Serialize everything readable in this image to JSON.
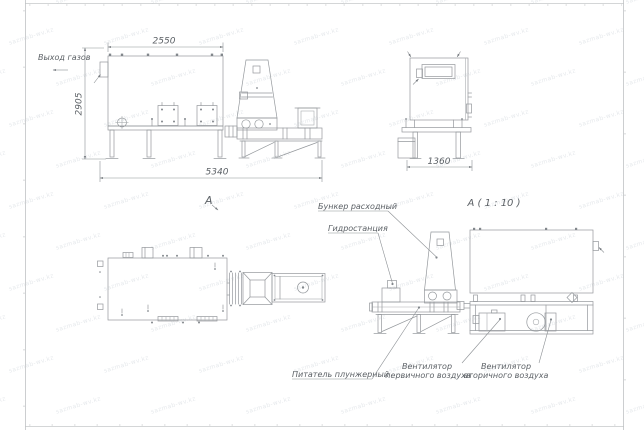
{
  "sheet": {
    "type": "technical-drawing",
    "background": "#ffffff",
    "line_color": "#94989c",
    "text_color": "#5c6166",
    "frame_color": "#b8bcbf"
  },
  "watermark": {
    "text": "sazmab-wv.kz"
  },
  "views": {
    "side": {
      "view_label": "А",
      "dim_top": "2550",
      "dim_left": "2905",
      "dim_bottom": "5340",
      "gas_outlet_label": "Выход газов"
    },
    "end": {
      "view_label": "А ( 1 : 10 )",
      "dim_bottom": "1360"
    },
    "detail": {
      "hopper_label": "Бункер расходный",
      "hydraulic_label": "Гидростанция",
      "feeder_label": "Питатель плунжерный",
      "primary_fan_label": [
        "Вентилятор",
        "первичного воздуха"
      ],
      "secondary_fan_label": [
        "Вентилятор",
        "вторичного воздуха"
      ]
    }
  }
}
